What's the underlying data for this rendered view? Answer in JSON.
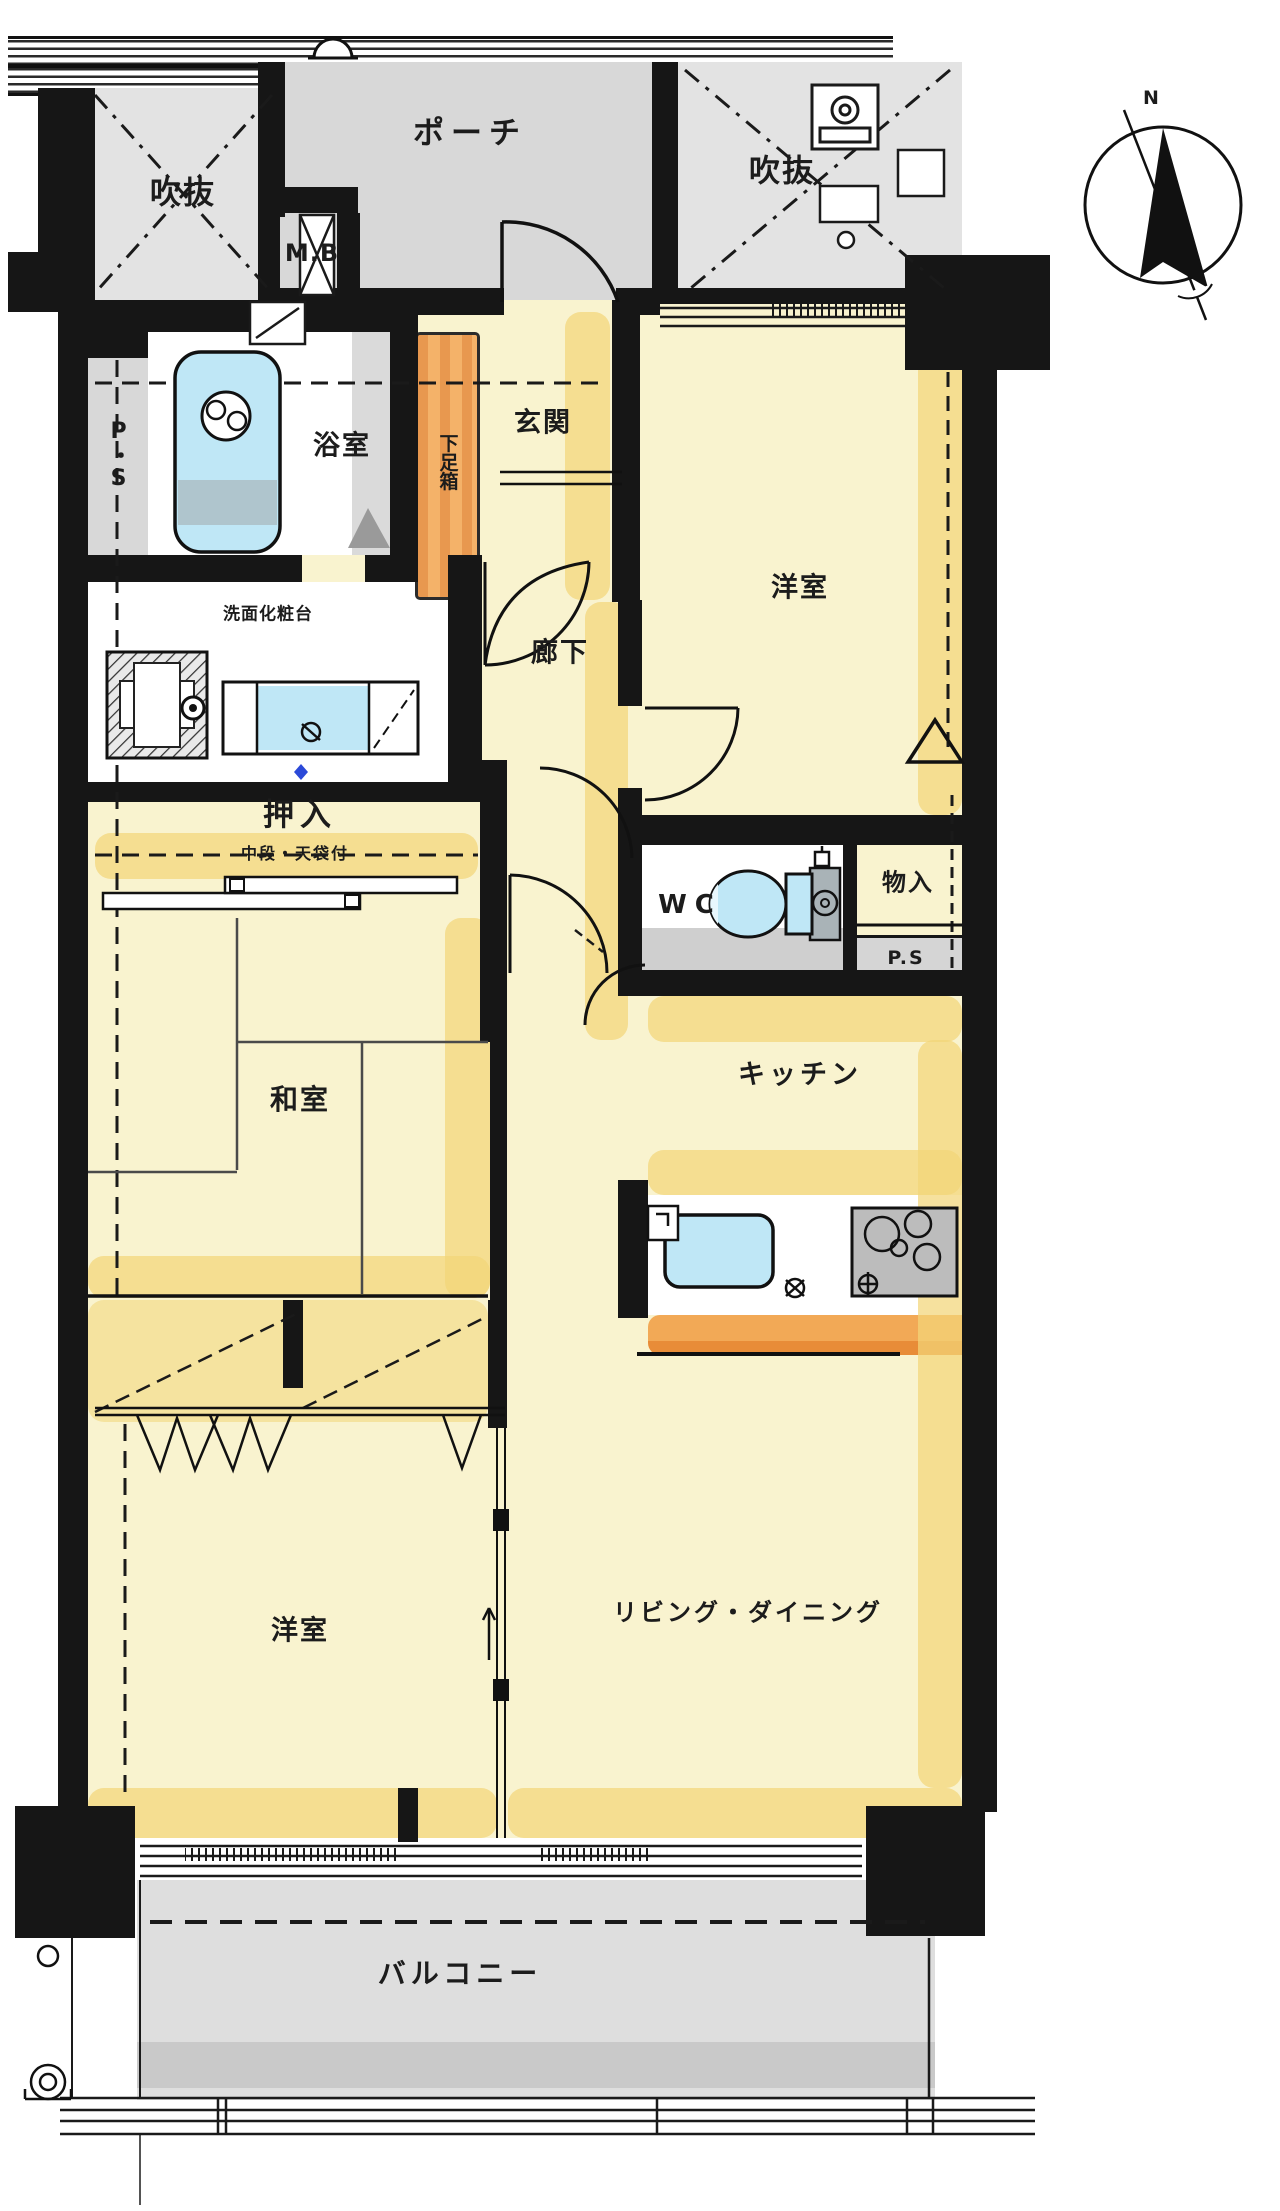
{
  "page": {
    "type": "Japanese apartment floor plan (madori)"
  },
  "labels": {
    "void_upper_left": "吹抜",
    "porch": "ポーチ",
    "meter_box": "M.B",
    "void_upper_right": "吹抜",
    "compass_north": "N",
    "pipe_shaft_left": "P・S",
    "bathroom": "浴室",
    "shoe_cabinet": "下足箱",
    "entrance": "玄関",
    "bedroom_upper": "洋室",
    "vanity": "洗面化粧台",
    "corridor": "廊下",
    "oshiire": "押入",
    "oshiire_note": "中段・天袋付",
    "wc": "WC",
    "storage": "物入",
    "pipe_shaft_right": "P.S",
    "japanese_room": "和室",
    "kitchen": "キッチン",
    "bedroom_lower": "洋室",
    "living_dining": "リビング・ダイニング",
    "balcony": "バルコニー"
  },
  "colors": {
    "wall": "#161616",
    "room_yellow": "#f9f3cf",
    "accent_yellow": "#f3d678",
    "common_gray": "#dcdcdc",
    "cabinet_orange": "#f0a052",
    "counter_orange": "#ee9440",
    "fixture_blue": "#bfe7f6",
    "balcony_gray": "#dedede"
  }
}
